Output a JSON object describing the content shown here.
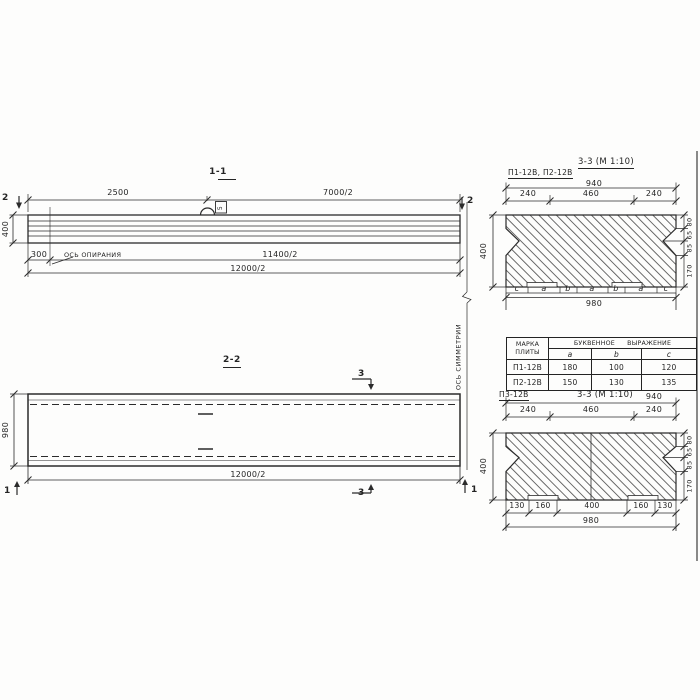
{
  "colors": {
    "line": "#2b2b2b",
    "background": "#fdfdfc"
  },
  "section_1_1": {
    "title": "1-1",
    "cut_marker": "2",
    "dim_top_left": "2500",
    "dim_top_right": "7000/2",
    "dim_height": "400",
    "dim_300": "300",
    "bearing_axis_label": "ОСЬ ОПИРАНИЯ",
    "dim_11400": "11400/2",
    "dim_12000": "12000/2",
    "loop_tag": "5"
  },
  "section_2_2": {
    "title": "2-2",
    "dim_width": "980",
    "dim_12000": "12000/2",
    "cut_marker_3": "3",
    "cut_marker_1": "1"
  },
  "symmetry_axis_label": "ОСЬ СИММЕТРИИ",
  "section_3_3_top": {
    "slab_label": "П1-12В, П2-12В",
    "title": "3-3 (М 1:10)",
    "dim_940": "940",
    "dim_240_left": "240",
    "dim_460": "460",
    "dim_240_right": "240",
    "dim_400": "400",
    "right_dims": [
      "80",
      "65",
      "85",
      "170"
    ],
    "letter_cells": [
      "c",
      "a",
      "b",
      "a",
      "b",
      "a",
      "c"
    ],
    "dim_980": "980"
  },
  "table": {
    "header_mark_line1": "МАРКА",
    "header_mark_line2": "ПЛИТЫ",
    "header_expression": "БУКВЕННОЕ ВЫРАЖЕНИЕ",
    "cols": [
      "a",
      "b",
      "c"
    ],
    "rows": [
      {
        "mark": "П1-12В",
        "a": "180",
        "b": "100",
        "c": "120"
      },
      {
        "mark": "П2-12В",
        "a": "150",
        "b": "130",
        "c": "135"
      }
    ]
  },
  "section_3_3_bottom": {
    "slab_label": "П3-12В",
    "title": "3-3 (М 1:10)",
    "dim_940": "940",
    "dim_240_left": "240",
    "dim_460": "460",
    "dim_240_right": "240",
    "dim_400": "400",
    "right_dims": [
      "80",
      "65",
      "85",
      "170"
    ],
    "bottom_dims": [
      "130",
      "160",
      "400",
      "160",
      "130"
    ],
    "dim_980": "980"
  }
}
